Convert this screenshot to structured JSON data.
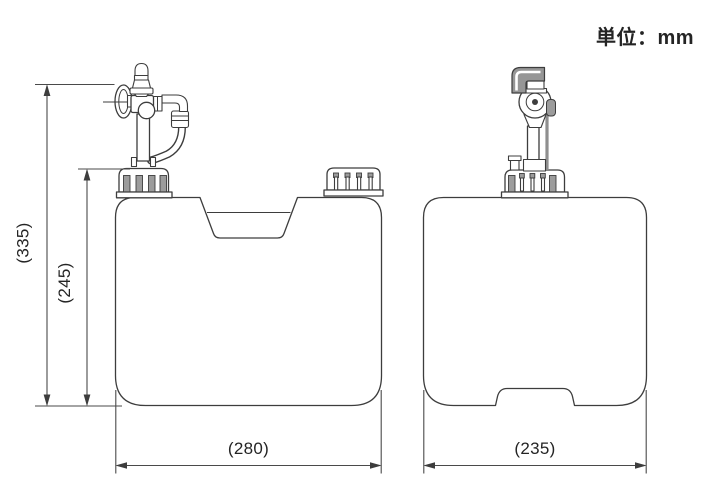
{
  "unit_label": "単位：mm",
  "dimensions": {
    "overall_height": "(335)",
    "body_height": "(245)",
    "front_width": "(280)",
    "side_width": "(235)"
  },
  "colors": {
    "background": "#ffffff",
    "line": "#3d3d3d",
    "dimension_line": "#4a4a4a",
    "text": "#242424",
    "metal_gray": "#9c9c9c"
  }
}
